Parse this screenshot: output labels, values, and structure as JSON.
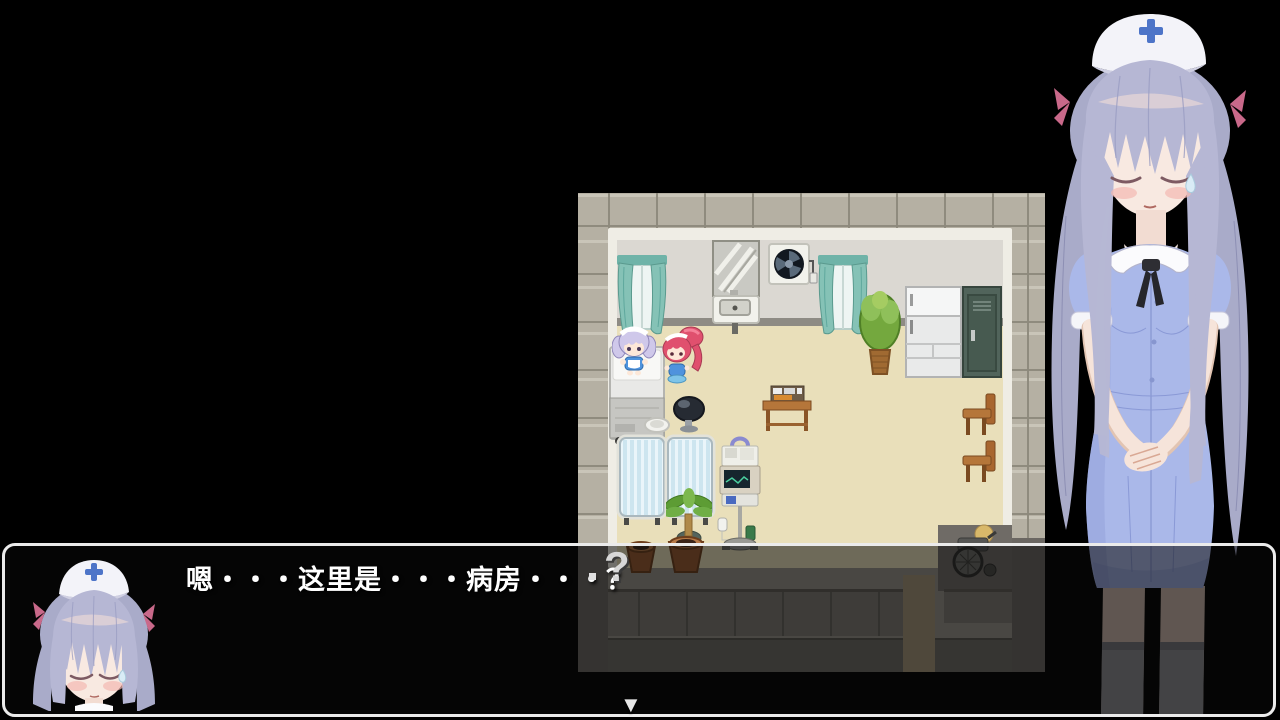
{
  "window": {
    "width": 1280,
    "height": 720,
    "background": "#000000"
  },
  "dialogue": {
    "text": "嗯・・・这里是・・・病房・・・？",
    "text_color": "#ffffff",
    "box_background": "rgba(10,10,10,0.55)",
    "box_border_color": "#ebebeb",
    "continue_symbol": "▼",
    "speaker_portrait": "nurse-bust-closed-eyes"
  },
  "map_scene": {
    "description": "hospital-ward-room",
    "emote_symbol": "?",
    "characters": [
      {
        "id": "maid-lavender-hair",
        "location": "on-bed"
      },
      {
        "id": "maid-red-ponytail",
        "location": "beside-bed"
      }
    ],
    "objects": [
      "window-curtains-left",
      "mirror",
      "ventilation-fan",
      "wall-sink",
      "window-curtains-right",
      "potted-tree",
      "refrigerator",
      "locker",
      "hospital-bed",
      "stool",
      "serving-plate",
      "food-table",
      "school-chair-upper",
      "school-chair-lower",
      "curtained-bed-left",
      "curtained-bed-right",
      "palm-plant",
      "iv-monitor-stand",
      "flower-pot-small",
      "flower-pot-large",
      "wheelchair"
    ],
    "palette": {
      "stone_tile": "#b5b0a3",
      "grout": "#8d897c",
      "wall_frame": "#efede5",
      "upper_wall": "#dbd8d2",
      "baseboard": "#8e8b84",
      "floor": "#e9dfba",
      "lower_wall": "#98938b",
      "panel": "#7e7a73",
      "corridor": "#6e6a65",
      "doorway": "#a59478"
    }
  },
  "right_portrait": {
    "id": "nurse-standing-closed-eyes",
    "hair_color": "#b6b7d4",
    "dress_color": "#aab8e9",
    "cap_cross_color": "#4d74c8",
    "ribbon_color": "#c9698a",
    "stocking_color": "#8b8b8f"
  }
}
